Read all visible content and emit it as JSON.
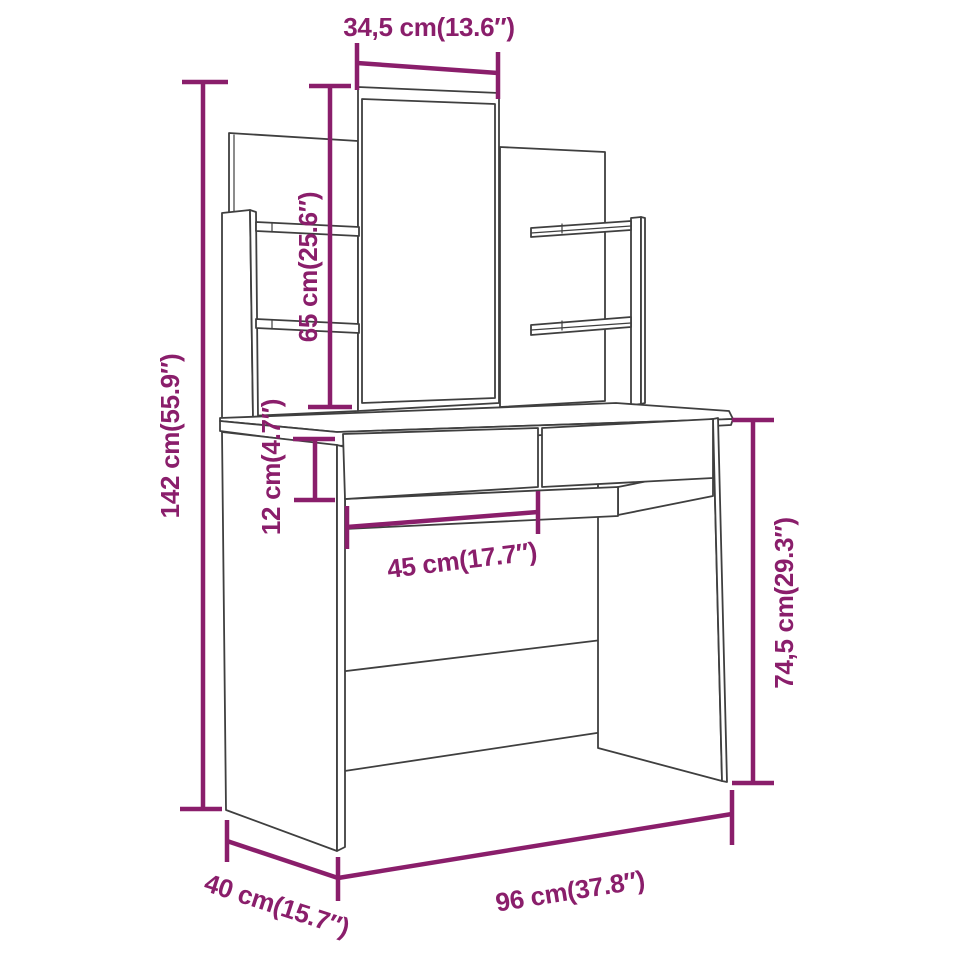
{
  "diagram": {
    "subject": "Dressing table with mirror, side shelves and two drawers — dimension drawing",
    "background": "#FFFFFF",
    "colors": {
      "dimension_accent": "#8A1E6B",
      "line_art": "#3F3F3F"
    },
    "dimensions": {
      "mirror_width": "34,5 cm(13.6″)",
      "total_height": "142 cm(55.9″)",
      "mirror_height": "65 cm(25.6″)",
      "drawer_height": "12 cm(4.7″)",
      "under_drawer_width": "45 cm(17.7″)",
      "table_height": "74,5 cm(29.3″)",
      "total_width": "96 cm(37.8″)",
      "depth": "40 cm(15.7″)"
    }
  }
}
